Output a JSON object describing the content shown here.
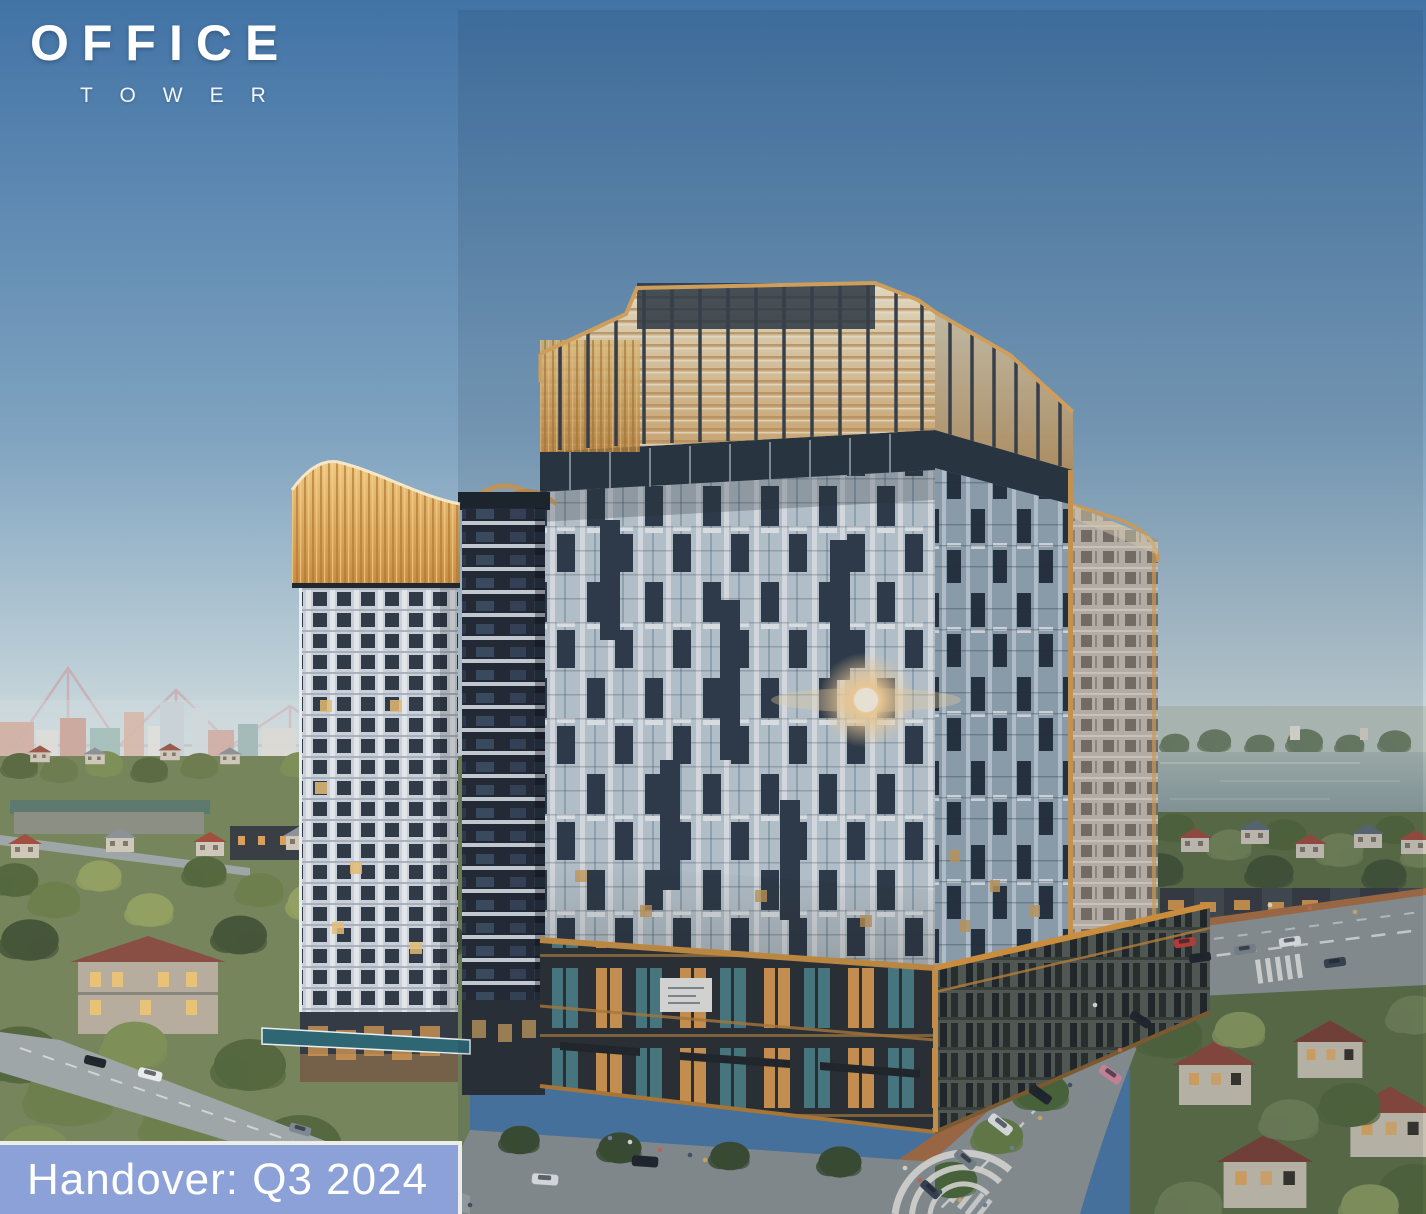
{
  "logo": {
    "title": "OFFICE",
    "subtitle": "TOWER"
  },
  "banner": {
    "label": "Handover: Q3 2024"
  },
  "scene": {
    "alt": "Aerial dusk rendering of the OFFICE tower complex: high-rises with golden louvered crowns above a lit retail podium, tree-lined streets with cars and pedestrians, low-rise houses, a lake and a distant skyline with a cable-stayed bridge"
  },
  "palette": {
    "banner-bg": "#8BA1D7",
    "banner-border": "#ECECE8",
    "banner-text": "#FFFFFF",
    "sky-top": "#3F6FA2",
    "sky-horizon": "#C9D8DC",
    "gold": "#DFA75C",
    "crown-cream": "#F0DFBB",
    "facade-light": "#D5DDE3",
    "facade-shadow": "#97A8B5",
    "facade-dark": "#333E4C",
    "podium": "#2F3338",
    "podium-light-warm": "#DE9E58",
    "podium-light-teal": "#4F868C",
    "water": "#95A5A3",
    "foliage": "#6E8052",
    "roof-red": "#9C4F41",
    "road": "#8F9698",
    "sidewalk": "#A96F44",
    "glint": "#FFD9A0"
  }
}
